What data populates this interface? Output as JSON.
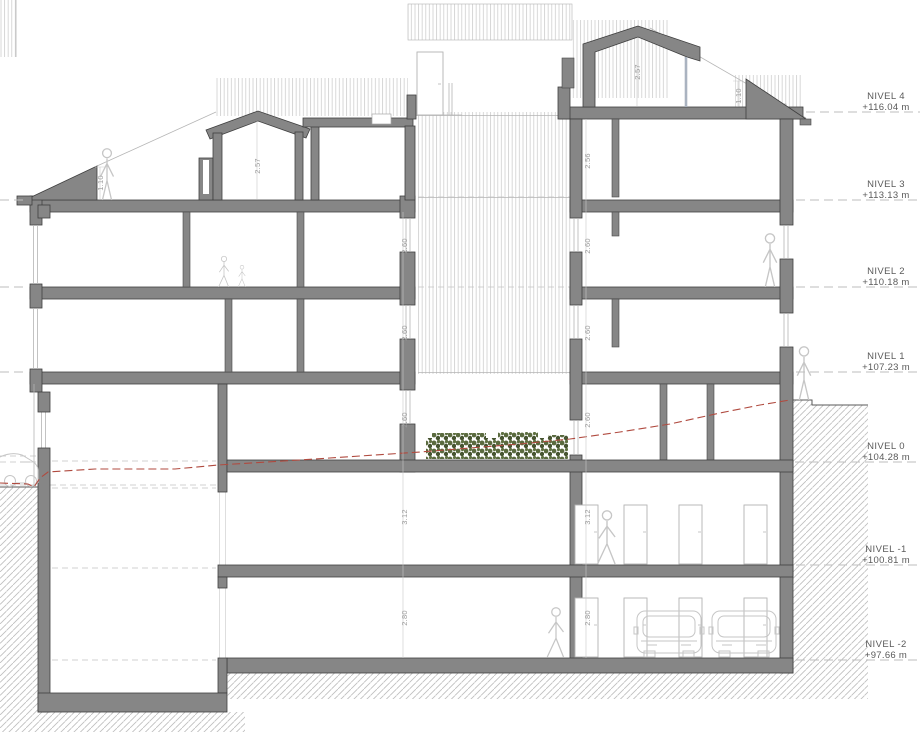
{
  "meta": {
    "type": "architectural-section",
    "units": "m"
  },
  "levels": [
    {
      "name": "NIVEL 4",
      "elevation": "+116.04 m"
    },
    {
      "name": "NIVEL 3",
      "elevation": "+113.13 m"
    },
    {
      "name": "NIVEL 2",
      "elevation": "+110.18 m"
    },
    {
      "name": "NIVEL 1",
      "elevation": "+107.23 m"
    },
    {
      "name": "NIVEL 0",
      "elevation": "+104.28 m"
    },
    {
      "name": "NIVEL -1",
      "elevation": "+100.81 m"
    },
    {
      "name": "NIVEL -2",
      "elevation": "+97.66 m"
    }
  ],
  "dims": [
    {
      "label": "1.10"
    },
    {
      "label": "2.57"
    },
    {
      "label": "2.57"
    },
    {
      "label": "1.10"
    },
    {
      "label": "2.56"
    },
    {
      "label": "2.60"
    },
    {
      "label": "2.60"
    },
    {
      "label": "2.60"
    },
    {
      "label": "2.60"
    },
    {
      "label": "2.60"
    },
    {
      "label": "2.60"
    },
    {
      "label": "3.12"
    },
    {
      "label": "3.12"
    },
    {
      "label": "2.80"
    },
    {
      "label": "2.80"
    }
  ],
  "colors": {
    "wall": "#868686",
    "wall_outline": "#3f3f3f",
    "hatch": "#cccccc",
    "ground_hatch": "#bdbdbd",
    "terrain_line": "#b04a3f",
    "vegetation": "#5a6a3e",
    "vegetation_dark": "#475531",
    "sketch": "#c6c6c6",
    "label_text": "#5a5a5a",
    "dim_text": "#9b9b9b"
  }
}
